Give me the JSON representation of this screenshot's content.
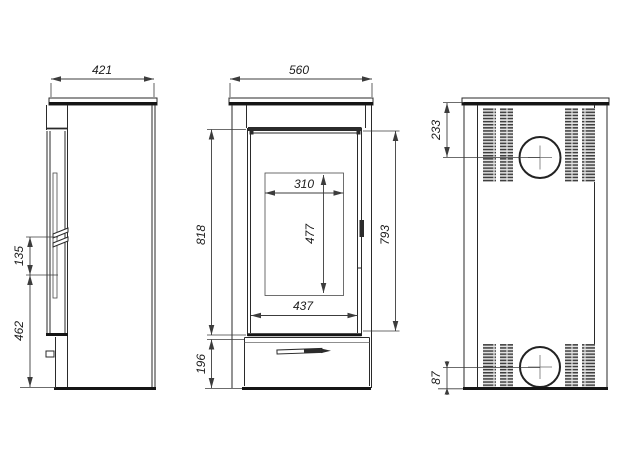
{
  "palette": {
    "line": "#2a2a2a",
    "background": "#ffffff"
  },
  "views": {
    "side": {
      "dim_top_depth": "421",
      "dim_handle_span": "135",
      "dim_handle_height": "462"
    },
    "front": {
      "dim_top_width": "560",
      "dim_door_height": "818",
      "dim_glass_inner_width": "310",
      "dim_glass_inner_height": "477",
      "dim_glass_width": "437",
      "dim_base_height": "196",
      "dim_door_opening_height": "793"
    },
    "back": {
      "dim_flue_top_offset": "233",
      "dim_flue_bottom_offset": "87"
    }
  }
}
